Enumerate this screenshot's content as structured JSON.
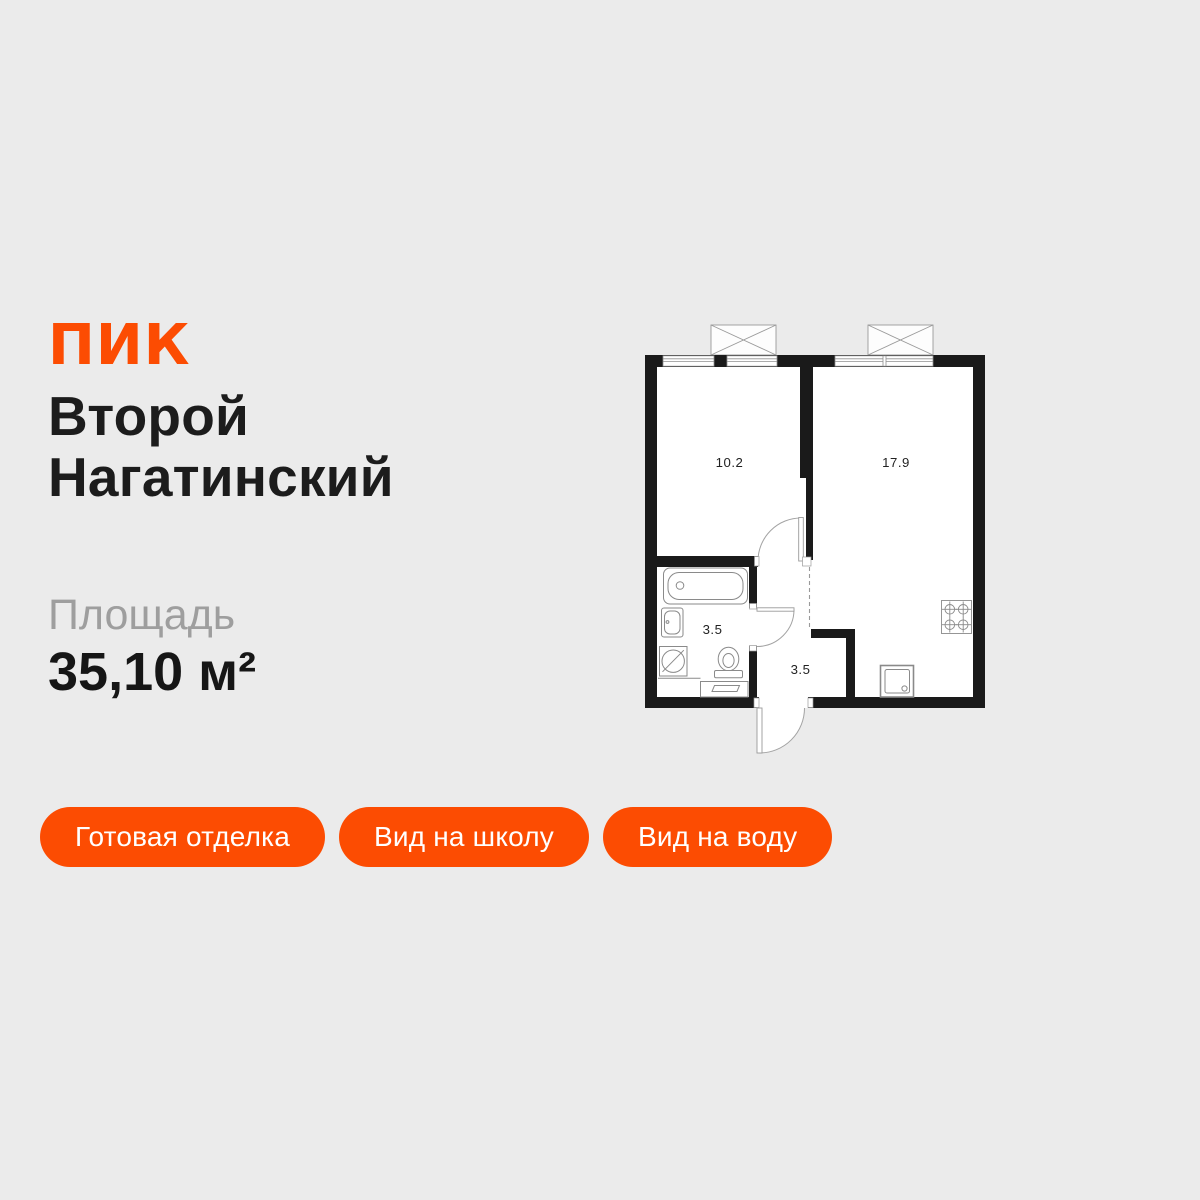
{
  "page": {
    "background_color": "#EBEBEB"
  },
  "brand": {
    "logo_text": "ПИК",
    "color": "#FC4C02"
  },
  "listing": {
    "title": "Второй Нагатинский",
    "area_label": "Площадь",
    "area_value": "35,10 м²"
  },
  "tags": {
    "background_color": "#FC4C02",
    "items": [
      {
        "label": "Готовая отделка"
      },
      {
        "label": "Вид на школу"
      },
      {
        "label": "Вид на воду"
      }
    ]
  },
  "floorplan": {
    "wall_color": "#1A1A1A",
    "room_labels": {
      "bedroom": "10.2",
      "living_kitchen": "17.9",
      "bathroom": "3.5",
      "hallway": "3.5"
    }
  }
}
